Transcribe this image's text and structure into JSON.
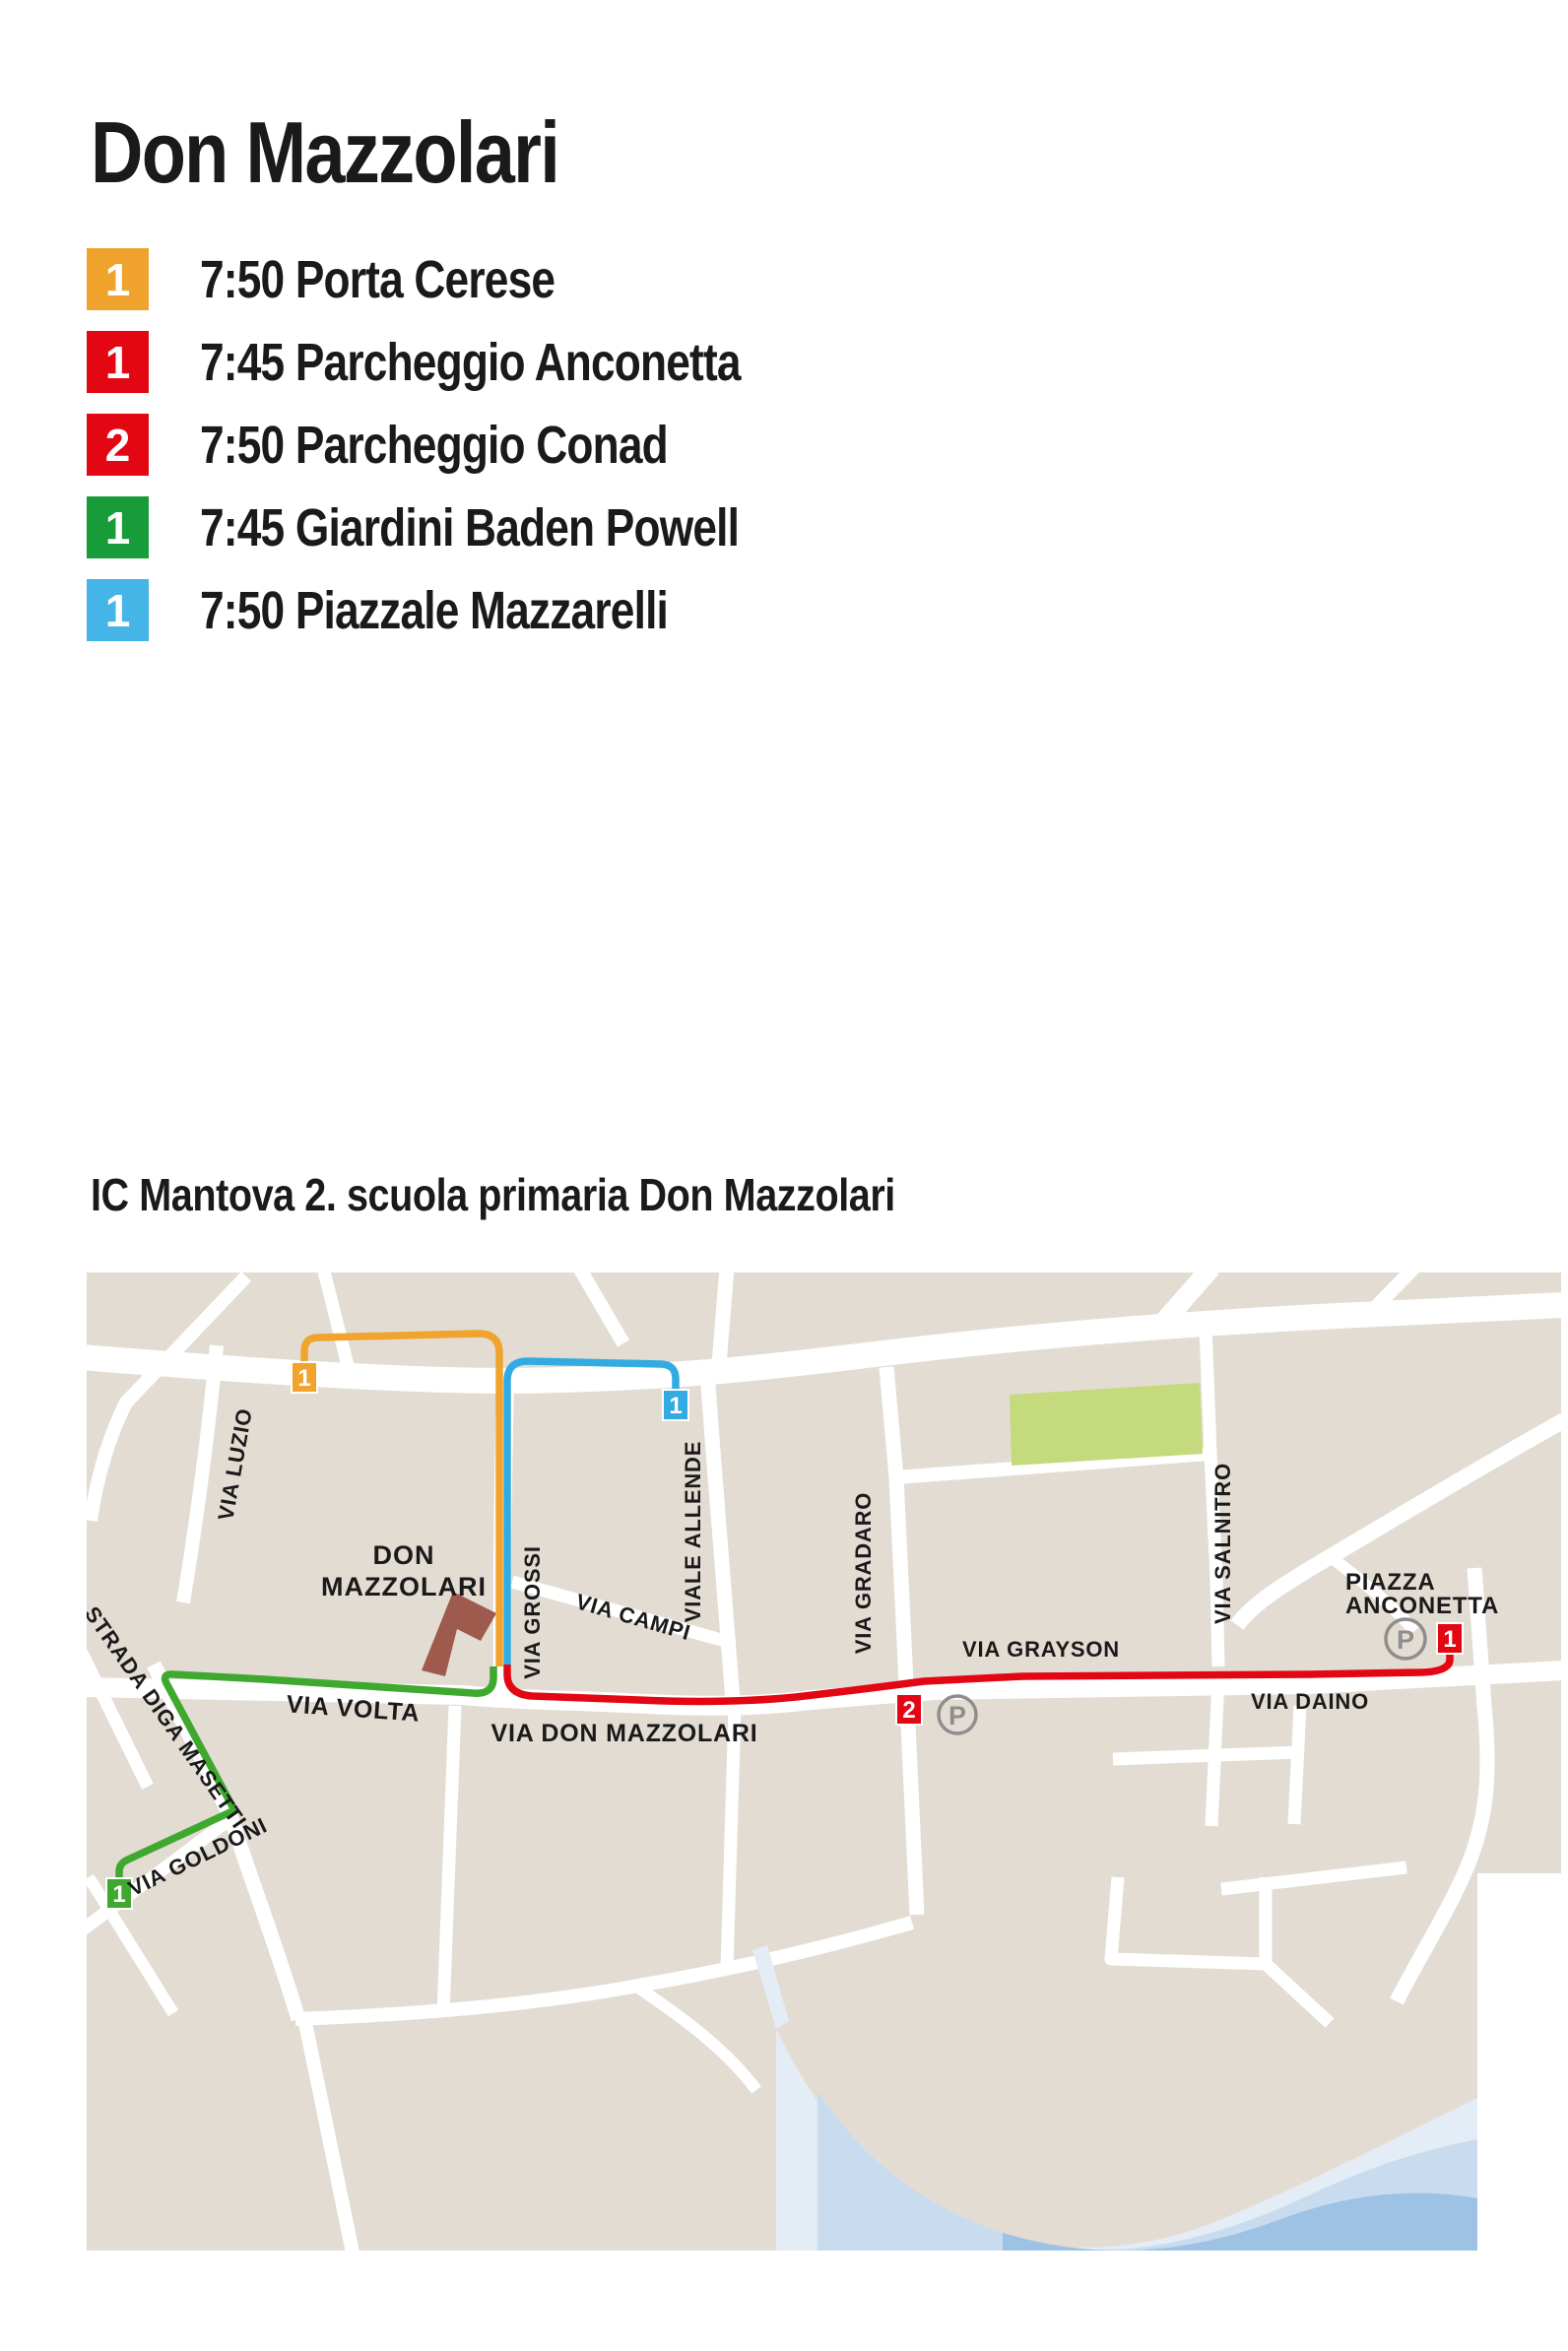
{
  "header": {
    "title": "Don Mazzolari"
  },
  "legend": [
    {
      "badge": "1",
      "color": "#EFA32C",
      "label": "7:50 Porta Cerese"
    },
    {
      "badge": "1",
      "color": "#E30613",
      "label": "7:45 Parcheggio Anconetta"
    },
    {
      "badge": "2",
      "color": "#E30613",
      "label": "7:50 Parcheggio Conad"
    },
    {
      "badge": "1",
      "color": "#189C3A",
      "label": "7:45 Giardini Baden Powell"
    },
    {
      "badge": "1",
      "color": "#45B5E8",
      "label": "7:50 Piazzale Mazzarelli"
    }
  ],
  "map_section": {
    "title": "IC Mantova 2. scuola primaria Don Mazzolari"
  },
  "map": {
    "school": {
      "line1": "DON",
      "line2": "MAZZOLARI"
    },
    "streets": {
      "luzio": "VIA LUZIO",
      "grossi": "VIA GROSSI",
      "allende": "VIALE ALLENDE",
      "campi": "VIA CAMPI",
      "gradaro": "VIA GRADARO",
      "grayson": "VIA GRAYSON",
      "salnitro": "VIA SALNITRO",
      "daino": "VIA DAINO",
      "volta": "VIA VOLTA",
      "don_mazzolari": "VIA DON MAZZOLARI",
      "masetti": "STRADA DIGA MASETTI",
      "goldoni": "VIA GOLDONI"
    },
    "piazza": {
      "line1": "PIAZZA",
      "line2": "ANCONETTA"
    },
    "markers": {
      "orange_1": "1",
      "blue_1": "1",
      "green_1": "1",
      "red_1": "1",
      "red_2": "2",
      "parking": "P"
    },
    "colors": {
      "route_orange": "#F0A42E",
      "route_blue": "#33ABE2",
      "route_green": "#3FA92F",
      "route_red": "#E30613",
      "map_background": "#E3DCD3",
      "park": "#C5D97D",
      "water_light": "#E4ECF5",
      "water_mid": "#C9DCEF",
      "water_deep": "#9DC2E3",
      "building": "#9E5A4D"
    }
  }
}
